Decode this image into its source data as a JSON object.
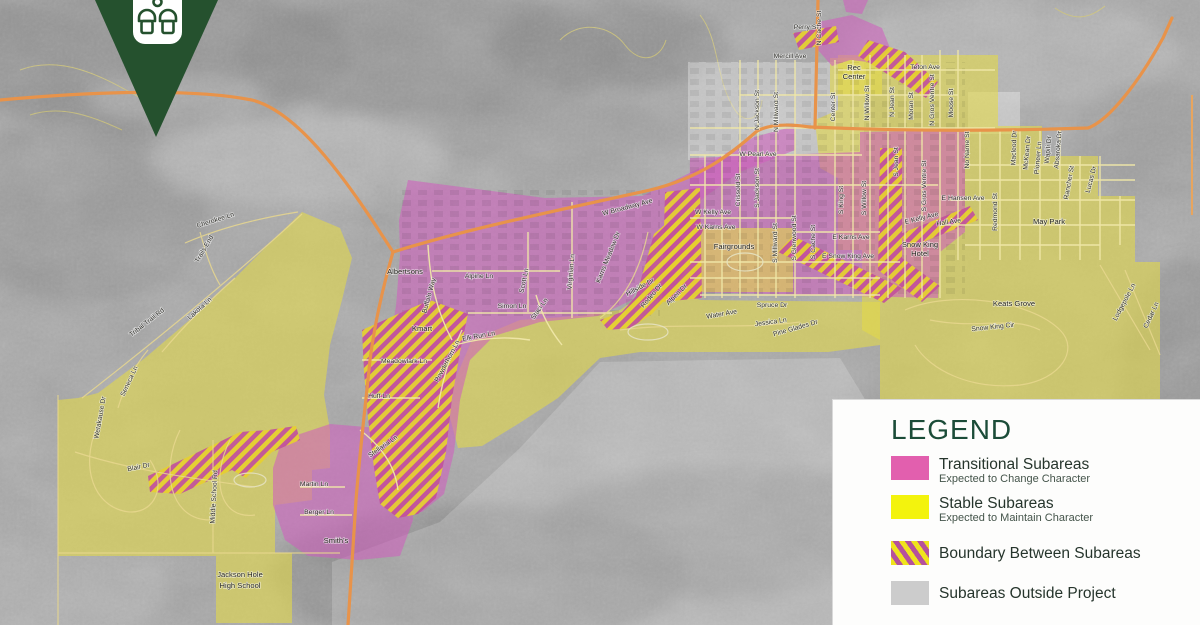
{
  "logo": {
    "icon": "lodging-icon"
  },
  "legend": {
    "title": "LEGEND",
    "title_color": "#1b4c38",
    "items": [
      {
        "label": "Transitional Subareas",
        "sublabel": "Expected to Change Character",
        "swatch": "#e25fae",
        "swatch_type": "solid"
      },
      {
        "label": "Stable Subareas",
        "sublabel": "Expected to Maintain Character",
        "swatch": "#f3f30d",
        "swatch_type": "solid"
      },
      {
        "label": "Boundary Between Subareas",
        "sublabel": "",
        "swatch": "pink-yellow-diagonal-stripes",
        "swatch_type": "hatch"
      },
      {
        "label": "Subareas Outside Project",
        "sublabel": "",
        "swatch": "#cccccc",
        "swatch_type": "solid"
      }
    ]
  },
  "map": {
    "colors": {
      "transitional": "#cf5fbd",
      "stable": "#e2d949",
      "boundary_stripe_pink": "#c2519b",
      "boundary_stripe_yellow": "#e6cf2e",
      "major_road": "#e8934a",
      "minor_road": "#efe7a8",
      "outside_overlay": "#cccccc",
      "aerial_base": "#a9a9a9"
    },
    "labels": [
      {
        "t": "Perry St",
        "x": 806,
        "y": 29,
        "r": 0
      },
      {
        "t": "N Cache St",
        "x": 821,
        "y": 28,
        "r": -90
      },
      {
        "t": "Mercill Ave",
        "x": 790,
        "y": 58,
        "r": 0
      },
      {
        "t": "Rec",
        "x": 854,
        "y": 70,
        "r": 0,
        "k": "place"
      },
      {
        "t": "Center",
        "x": 854,
        "y": 79,
        "r": 0,
        "k": "place"
      },
      {
        "t": "Teton Ave",
        "x": 925,
        "y": 69,
        "r": 0
      },
      {
        "t": "N Jackson St",
        "x": 759,
        "y": 110,
        "r": -90
      },
      {
        "t": "N Millward St",
        "x": 778,
        "y": 112,
        "r": -90
      },
      {
        "t": "Center St",
        "x": 835,
        "y": 107,
        "r": -90
      },
      {
        "t": "N Willow St",
        "x": 869,
        "y": 103,
        "r": -90
      },
      {
        "t": "N Jean St",
        "x": 894,
        "y": 102,
        "r": -90
      },
      {
        "t": "Moran St",
        "x": 913,
        "y": 106,
        "r": -90
      },
      {
        "t": "N Gros Ventre St",
        "x": 934,
        "y": 100,
        "r": -90
      },
      {
        "t": "Moose St",
        "x": 953,
        "y": 103,
        "r": -90
      },
      {
        "t": "W Pearl Ave",
        "x": 758,
        "y": 156,
        "r": 0
      },
      {
        "t": "Crissold St",
        "x": 740,
        "y": 190,
        "r": -90
      },
      {
        "t": "S Jackson St",
        "x": 759,
        "y": 188,
        "r": -90
      },
      {
        "t": "S Millward St",
        "x": 777,
        "y": 243,
        "r": -90
      },
      {
        "t": "S Glenwood St",
        "x": 796,
        "y": 238,
        "r": -90
      },
      {
        "t": "S Cache St",
        "x": 815,
        "y": 242,
        "r": -90
      },
      {
        "t": "S King St",
        "x": 843,
        "y": 200,
        "r": -90
      },
      {
        "t": "S Willow St",
        "x": 866,
        "y": 198,
        "r": -90
      },
      {
        "t": "S Jean St",
        "x": 898,
        "y": 162,
        "r": -90
      },
      {
        "t": "S Gros Ventre St",
        "x": 926,
        "y": 186,
        "r": -90
      },
      {
        "t": "W Kelly Ave",
        "x": 713,
        "y": 214,
        "r": 0
      },
      {
        "t": "W Karns Ave",
        "x": 716,
        "y": 229,
        "r": 0
      },
      {
        "t": "Fairgrounds",
        "x": 734,
        "y": 249,
        "r": 0,
        "k": "place"
      },
      {
        "t": "E Karns Ave",
        "x": 851,
        "y": 239,
        "r": 0
      },
      {
        "t": "E Snow King Ave",
        "x": 848,
        "y": 258,
        "r": 0
      },
      {
        "t": "E Kelly Ave",
        "x": 922,
        "y": 220,
        "r": -14
      },
      {
        "t": "Snow King",
        "x": 920,
        "y": 247,
        "r": 0,
        "k": "place"
      },
      {
        "t": "Hotel",
        "x": 920,
        "y": 256,
        "r": 0,
        "k": "place"
      },
      {
        "t": "E Hansen Ave",
        "x": 963,
        "y": 200,
        "r": 0
      },
      {
        "t": "Hall Ave",
        "x": 949,
        "y": 224,
        "r": -8
      },
      {
        "t": "Redmond St",
        "x": 997,
        "y": 212,
        "r": -90
      },
      {
        "t": "May Park",
        "x": 1049,
        "y": 224,
        "r": 0,
        "k": "place"
      },
      {
        "t": "No Name St",
        "x": 969,
        "y": 150,
        "r": -90
      },
      {
        "t": "Macleod Dr",
        "x": 1016,
        "y": 148,
        "r": -88
      },
      {
        "t": "McKean Dr",
        "x": 1029,
        "y": 153,
        "r": -85
      },
      {
        "t": "Pioneer Ln",
        "x": 1040,
        "y": 158,
        "r": -85
      },
      {
        "t": "Wapiti Dr",
        "x": 1050,
        "y": 150,
        "r": -85
      },
      {
        "t": "Absaroka Dr",
        "x": 1060,
        "y": 150,
        "r": -85
      },
      {
        "t": "Rancher St",
        "x": 1071,
        "y": 183,
        "r": -80
      },
      {
        "t": "Lucas Dr",
        "x": 1093,
        "y": 180,
        "r": -75
      },
      {
        "t": "Keats Grove",
        "x": 1014,
        "y": 306,
        "r": 0,
        "k": "place"
      },
      {
        "t": "Snow King Cir",
        "x": 993,
        "y": 329,
        "r": -6
      },
      {
        "t": "Lodgepole Ln",
        "x": 1126,
        "y": 303,
        "r": -62
      },
      {
        "t": "Cedar Ln",
        "x": 1153,
        "y": 316,
        "r": -65
      },
      {
        "t": "W Broadway Ave",
        "x": 628,
        "y": 209,
        "r": -15
      },
      {
        "t": "Karns Meadow Dr",
        "x": 610,
        "y": 258,
        "r": -68
      },
      {
        "t": "Hillside Dr",
        "x": 641,
        "y": 289,
        "r": -28
      },
      {
        "t": "Rodeo Dr",
        "x": 653,
        "y": 297,
        "r": -50
      },
      {
        "t": "Alpen Dr",
        "x": 678,
        "y": 296,
        "r": -45
      },
      {
        "t": "Water Ave",
        "x": 722,
        "y": 316,
        "r": -10
      },
      {
        "t": "Spruce Dr",
        "x": 772,
        "y": 307,
        "r": 0
      },
      {
        "t": "Jessica Ln",
        "x": 771,
        "y": 324,
        "r": -8
      },
      {
        "t": "Pine Glades Dr",
        "x": 796,
        "y": 330,
        "r": -16
      },
      {
        "t": "Albertsons",
        "x": 405,
        "y": 274,
        "r": 0,
        "k": "place"
      },
      {
        "t": "Buffalo Way",
        "x": 431,
        "y": 296,
        "r": -75
      },
      {
        "t": "Alpine Ln",
        "x": 479,
        "y": 278,
        "r": 0
      },
      {
        "t": "Scott Ln",
        "x": 526,
        "y": 281,
        "r": -78
      },
      {
        "t": "Simon Ln",
        "x": 512,
        "y": 308,
        "r": 0
      },
      {
        "t": "Staci Ln",
        "x": 541,
        "y": 310,
        "r": -55
      },
      {
        "t": "Virginian Ln",
        "x": 573,
        "y": 272,
        "r": -85
      },
      {
        "t": "Kmart",
        "x": 422,
        "y": 331,
        "r": 0,
        "k": "place"
      },
      {
        "t": "Powderhorn Ln",
        "x": 449,
        "y": 362,
        "r": -62
      },
      {
        "t": "Elk Run Ln",
        "x": 479,
        "y": 338,
        "r": -10
      },
      {
        "t": "Meadowlark Ln",
        "x": 404,
        "y": 363,
        "r": 0
      },
      {
        "t": "Huff Ln",
        "x": 379,
        "y": 398,
        "r": 0
      },
      {
        "t": "Stellaria Ln",
        "x": 384,
        "y": 448,
        "r": -35
      },
      {
        "t": "Cherokee Ln",
        "x": 216,
        "y": 222,
        "r": -18
      },
      {
        "t": "Trails End",
        "x": 206,
        "y": 250,
        "r": -60
      },
      {
        "t": "Lakota Ln",
        "x": 201,
        "y": 310,
        "r": -42
      },
      {
        "t": "Tribal Trail Rd",
        "x": 148,
        "y": 324,
        "r": -38
      },
      {
        "t": "Seneca Ln",
        "x": 131,
        "y": 382,
        "r": -65
      },
      {
        "t": "Wetakause Dr",
        "x": 102,
        "y": 418,
        "r": -80
      },
      {
        "t": "Blair Dr",
        "x": 139,
        "y": 469,
        "r": -12
      },
      {
        "t": "Middle School Rd",
        "x": 216,
        "y": 497,
        "r": -87
      },
      {
        "t": "Jackson Hole",
        "x": 240,
        "y": 577,
        "r": 0,
        "k": "place"
      },
      {
        "t": "High School",
        "x": 240,
        "y": 588,
        "r": 0,
        "k": "place"
      },
      {
        "t": "Martin Ln",
        "x": 314,
        "y": 486,
        "r": 0
      },
      {
        "t": "Berger Ln",
        "x": 319,
        "y": 514,
        "r": 0
      },
      {
        "t": "Smith's",
        "x": 336,
        "y": 543,
        "r": 0,
        "k": "place"
      }
    ]
  }
}
